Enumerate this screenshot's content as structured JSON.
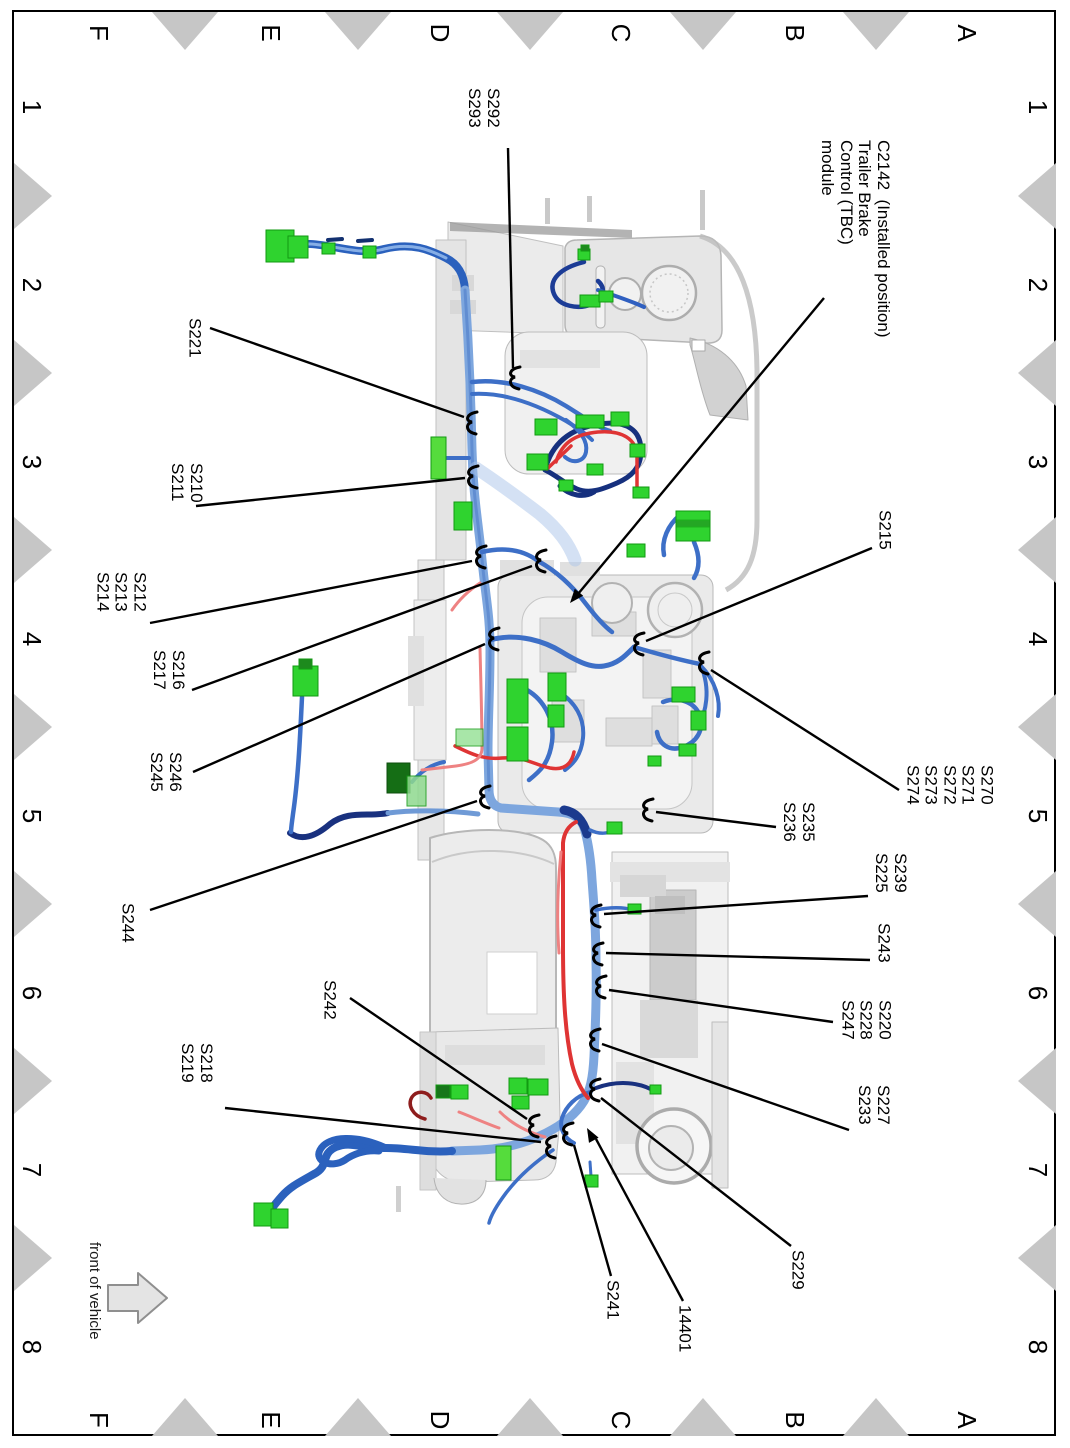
{
  "page": {
    "width": 1070,
    "height": 1448,
    "background": "#ffffff",
    "border_color": "#000000"
  },
  "grid": {
    "letters": [
      "F",
      "E",
      "D",
      "C",
      "B",
      "A"
    ],
    "numbers": [
      "1",
      "2",
      "3",
      "4",
      "5",
      "6",
      "7",
      "8"
    ],
    "letter_x": [
      99,
      271,
      440,
      621,
      795,
      967
    ],
    "number_y": [
      107,
      285,
      462,
      639,
      816,
      993,
      1170,
      1347
    ],
    "top_y": 33,
    "bottom_y": 1420,
    "left_x": 32,
    "right_x": 1038,
    "triangle_color": "#c6c6c6",
    "tri_top_x": [
      185,
      358,
      530,
      703,
      876
    ],
    "tri_side_y": [
      196,
      373,
      550,
      727,
      904,
      1081,
      1258
    ]
  },
  "front_arrow": {
    "label": "front of vehicle",
    "text_x": 86,
    "text_y": 1242,
    "fill": "#e4e4e4",
    "stroke": "#8f8f8f"
  },
  "callout_style": {
    "leader_color": "#000000",
    "clip_color": "#000000"
  },
  "drawing_colors": {
    "harness_blue": "#2b61bd",
    "trunk_blue": "#7da6de",
    "navy": "#19317f",
    "red": "#df3434",
    "pink": "#ee8282",
    "dark_red": "#8e1d1d",
    "connector_green": "#2fd32f",
    "connector_dark_green": "#156e15",
    "structure_gray": "#e9e9e9"
  },
  "callouts": [
    {
      "id": "s292-s293",
      "text": "S292\nS293",
      "x": 465,
      "y": 88,
      "leader": [
        508,
        148,
        513,
        368
      ],
      "end": "clip",
      "tip": [
        514,
        378
      ]
    },
    {
      "id": "c2142-tbc",
      "text": "C2142  (Installed position)\nTrailer Brake\nControl (TBC)\nmodule",
      "x": 818,
      "y": 140,
      "leader": [
        824,
        298,
        578,
        594
      ],
      "end": "arrow",
      "tip": [
        570,
        603
      ]
    },
    {
      "id": "s221",
      "text": "S221",
      "x": 185,
      "y": 318,
      "leader": [
        210,
        328,
        464,
        417
      ],
      "end": "clip",
      "tip": [
        471,
        423
      ]
    },
    {
      "id": "s210-s211",
      "text": "S210\nS211",
      "x": 168,
      "y": 463,
      "leader": [
        196,
        506,
        465,
        478
      ],
      "end": "clip",
      "tip": [
        472,
        477
      ]
    },
    {
      "id": "s212-s213-s214",
      "text": "S212\nS213\nS214",
      "x": 93,
      "y": 572,
      "leader": [
        150,
        623,
        472,
        561
      ],
      "end": "clip",
      "tip": [
        480,
        557
      ]
    },
    {
      "id": "s216-s217",
      "text": "S216\nS217",
      "x": 150,
      "y": 650,
      "leader": [
        192,
        690,
        532,
        566
      ],
      "end": "clip",
      "tip": [
        540,
        561
      ]
    },
    {
      "id": "s246-s245",
      "text": "S246\nS245",
      "x": 147,
      "y": 752,
      "leader": [
        193,
        772,
        485,
        644
      ],
      "end": "clip",
      "tip": [
        493,
        639
      ]
    },
    {
      "id": "s244",
      "text": "S244",
      "x": 118,
      "y": 903,
      "leader": [
        150,
        910,
        477,
        801
      ],
      "end": "clip",
      "tip": [
        484,
        797
      ]
    },
    {
      "id": "s215",
      "text": "S215",
      "x": 875,
      "y": 510,
      "leader": [
        872,
        548,
        646,
        641
      ],
      "end": "clip",
      "tip": [
        638,
        644
      ]
    },
    {
      "id": "s270-s274",
      "text": "S270\nS271\nS272\nS273\nS274",
      "x": 903,
      "y": 765,
      "leader": [
        899,
        790,
        711,
        670
      ],
      "end": "clip",
      "tip": [
        703,
        663
      ]
    },
    {
      "id": "s235-s236",
      "text": "S235\nS236",
      "x": 780,
      "y": 802,
      "leader": [
        776,
        827,
        656,
        812
      ],
      "end": "clip",
      "tip": [
        647,
        810
      ]
    },
    {
      "id": "s239-s225",
      "text": "S239\nS225",
      "x": 872,
      "y": 853,
      "leader": [
        868,
        896,
        604,
        914
      ],
      "end": "clip",
      "tip": [
        595,
        916
      ]
    },
    {
      "id": "s243",
      "text": "S243",
      "x": 874,
      "y": 923,
      "leader": [
        870,
        960,
        606,
        953
      ],
      "end": "clip",
      "tip": [
        597,
        954
      ]
    },
    {
      "id": "s220-s228-s247",
      "text": "S220\nS228\nS247",
      "x": 838,
      "y": 1000,
      "leader": [
        833,
        1022,
        609,
        990
      ],
      "end": "clip",
      "tip": [
        600,
        987
      ]
    },
    {
      "id": "s227-s233",
      "text": "S227\nS233",
      "x": 855,
      "y": 1085,
      "leader": [
        849,
        1130,
        602,
        1044
      ],
      "end": "clip",
      "tip": [
        594,
        1040
      ]
    },
    {
      "id": "s242",
      "text": "S242",
      "x": 320,
      "y": 980,
      "leader": [
        350,
        998,
        527,
        1119
      ],
      "end": "clip",
      "tip": [
        533,
        1126
      ]
    },
    {
      "id": "s218-s219",
      "text": "S218\nS219",
      "x": 178,
      "y": 1043,
      "leader": [
        225,
        1108,
        541,
        1142
      ],
      "end": "clip",
      "tip": [
        550,
        1147
      ]
    },
    {
      "id": "s229",
      "text": "S229",
      "x": 788,
      "y": 1250,
      "leader": [
        791,
        1246,
        601,
        1098
      ],
      "end": "clip",
      "tip": [
        594,
        1090
      ]
    },
    {
      "id": "s241",
      "text": "S241",
      "x": 603,
      "y": 1280,
      "leader": [
        611,
        1276,
        574,
        1145
      ],
      "end": "clip",
      "tip": [
        567,
        1134
      ]
    },
    {
      "id": "h14401",
      "text": "14401",
      "x": 675,
      "y": 1305,
      "leader": [
        683,
        1301,
        596,
        1139
      ],
      "end": "arrow",
      "tip": [
        587,
        1128
      ]
    }
  ]
}
